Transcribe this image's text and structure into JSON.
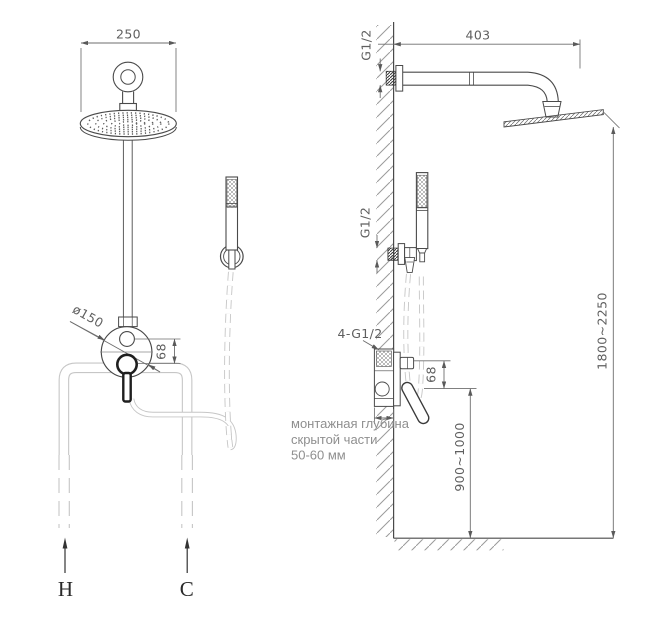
{
  "front_view": {
    "dim_head_width": "250",
    "dim_mixer_diameter": "ø150",
    "dim_port_offset": "68",
    "hot_label": "H",
    "cold_label": "C"
  },
  "side_view": {
    "dim_arm_length": "403",
    "arm_thread": "G1/2",
    "handshower_thread": "G1/2",
    "valve_threads": "4-G1/2",
    "dim_port_offset": "68",
    "dim_valve_height": "900~1000",
    "dim_head_height": "1800~2250",
    "note": {
      "line1": "монтажная глубина",
      "line2": "скрытой части",
      "line3": "50-60 мм"
    }
  },
  "colors": {
    "line": "#4a4a4a",
    "dim_line": "#6e6e6e",
    "dim_text": "#5f5f5f",
    "pipe": "#c6c6c6",
    "note_text": "#8f8f8f",
    "bold_part": "#1f1f1f"
  }
}
